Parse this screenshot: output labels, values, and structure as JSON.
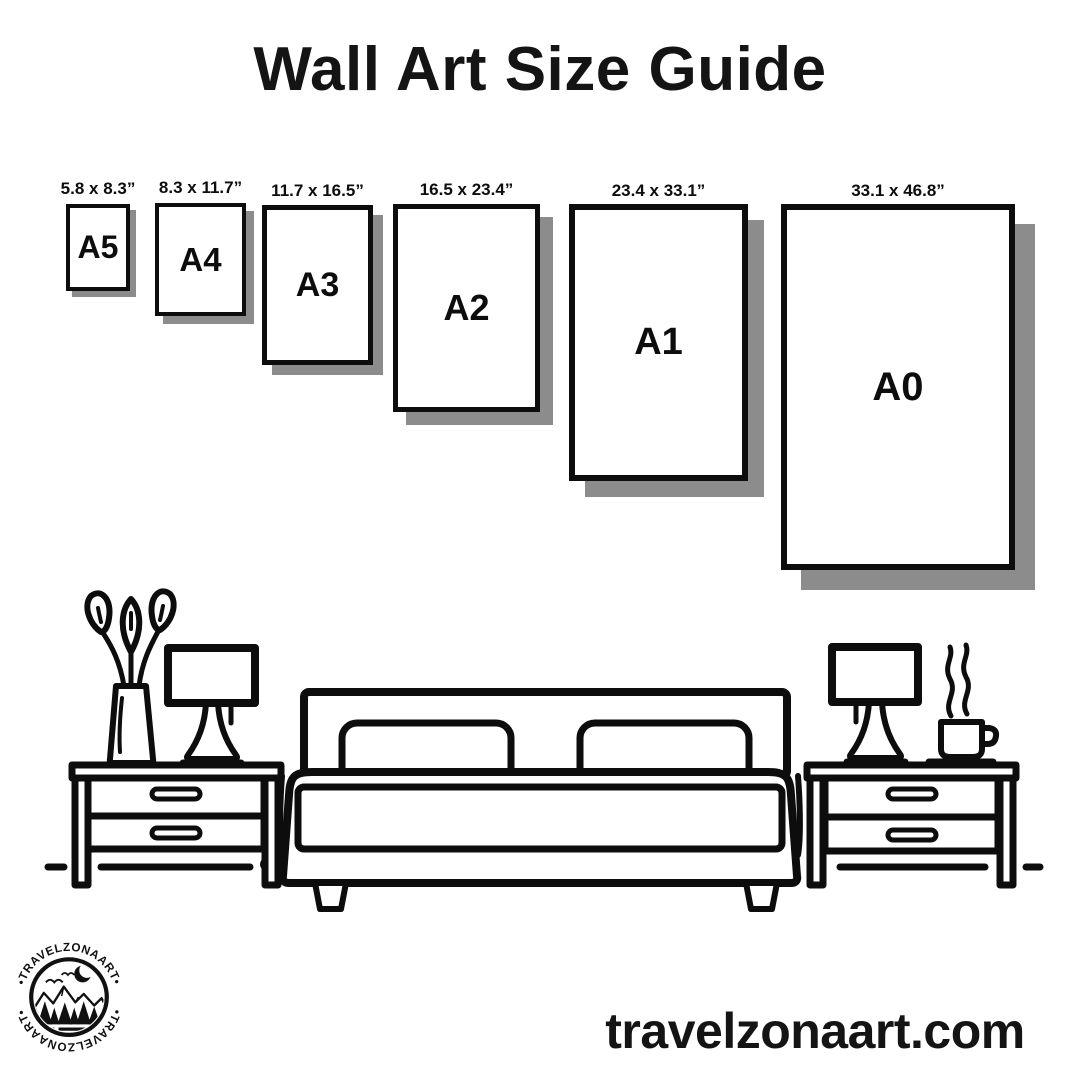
{
  "title": "Wall Art Size Guide",
  "papers": [
    {
      "name": "A5",
      "size": "5.8 x 8.3”"
    },
    {
      "name": "A4",
      "size": "8.3 x 11.7”"
    },
    {
      "name": "A3",
      "size": "11.7 x 16.5”"
    },
    {
      "name": "A2",
      "size": "16.5 x 23.4”"
    },
    {
      "name": "A1",
      "size": "23.4 x 33.1”"
    },
    {
      "name": "A0",
      "size": "33.1 x 46.8”"
    }
  ],
  "logo": {
    "badge_text": "•TRAVELZONAART•"
  },
  "footer": {
    "website": "travelzonaart.com"
  },
  "colors": {
    "ink": "#0d0d0d",
    "paper_shadow": "#8c8c8c",
    "background": "#ffffff"
  },
  "illustration": {
    "icons": [
      "flower-vase-icon",
      "table-lamp-icon",
      "nightstand-icon",
      "double-bed-icon",
      "pillow-icon",
      "coffee-cup-icon",
      "steam-icon",
      "floor-line-icon",
      "moon-icon",
      "mountain-icon",
      "pine-tree-icon",
      "bird-icon"
    ]
  }
}
